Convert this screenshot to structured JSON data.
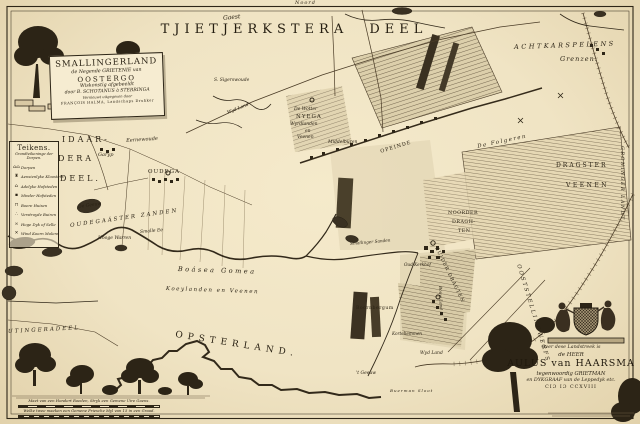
{
  "map": {
    "title": "TJIETJERKSTERA DEEL",
    "title_script": "Gaest",
    "north": "Noord"
  },
  "cartouche": {
    "l1": "SMALLINGERLAND",
    "l2": "de Negende GRIETENIE van",
    "l3": "OOSTERGO",
    "l4": "Wiskonstig afgebeeldt",
    "l5": "door B. SCHOTANUS à STERRINGA",
    "l6": "Vernieuwt uitgegeven door",
    "l7": "FRANÇOIS HALMA, Landschaps Drukker"
  },
  "legend": {
    "title": "Teikens.",
    "sub1": "Grondteikeninge der",
    "sub2": "Dorpen.",
    "items": [
      {
        "g": "⌂⌂",
        "t": "Dorpen"
      },
      {
        "g": "♜",
        "t": "Aensienlyke Kloosters"
      },
      {
        "g": "⌂",
        "t": "Adelyke Hofsteden"
      },
      {
        "g": "▪",
        "t": "Minder Hofsteden"
      },
      {
        "g": "⊓",
        "t": "Boere Huisen"
      },
      {
        "g": "∴",
        "t": "Verstroyde Buiren"
      },
      {
        "g": "≍",
        "t": "Hoge Dyk of Selle"
      },
      {
        "g": "✕",
        "t": "Wind Koorn Molens"
      }
    ]
  },
  "places": [
    {
      "id": "eernewoude",
      "text": "Eernewoude",
      "x": 126,
      "y": 139,
      "fs": 5,
      "it": true,
      "rot": -4
    },
    {
      "id": "garyp",
      "text": "Garyp",
      "x": 98,
      "y": 153,
      "fs": 5,
      "it": true
    },
    {
      "id": "sigerswoude",
      "text": "S. Sigerswoude",
      "x": 214,
      "y": 79,
      "fs": 4.5,
      "it": true
    },
    {
      "id": "wyd-land-noord",
      "text": "Wyd Land",
      "x": 227,
      "y": 112,
      "fs": 4.5,
      "it": true,
      "rot": -22
    },
    {
      "id": "de-wotter",
      "text": "De Wotter",
      "x": 294,
      "y": 108,
      "fs": 4.5,
      "it": true
    },
    {
      "id": "nyega",
      "text": "NYEGA",
      "x": 296,
      "y": 115,
      "fs": 5.5,
      "ls": 1
    },
    {
      "id": "wyrdlanden",
      "text": "Wyrdlanden",
      "x": 290,
      "y": 123,
      "fs": 4.5,
      "it": true
    },
    {
      "id": "en",
      "text": "en",
      "x": 305,
      "y": 130,
      "fs": 4.5,
      "it": true
    },
    {
      "id": "veenen-noord",
      "text": "Veenen",
      "x": 297,
      "y": 136,
      "fs": 4.5,
      "it": true
    },
    {
      "id": "middelburen",
      "text": "Middelburen",
      "x": 328,
      "y": 141,
      "fs": 4.5,
      "it": true
    },
    {
      "id": "opeinde",
      "text": "OPEINDE",
      "x": 380,
      "y": 150,
      "fs": 5,
      "ls": 1,
      "rot": -17
    },
    {
      "id": "de-folgeren",
      "text": "De Folgeren",
      "x": 477,
      "y": 145,
      "fs": 5.5,
      "it": true,
      "ls": 1.5,
      "rot": -12
    },
    {
      "id": "dragster",
      "text": "DRAGSTER",
      "x": 556,
      "y": 163,
      "fs": 6,
      "ls": 2
    },
    {
      "id": "veenen-oost",
      "text": "VEENEN",
      "x": 566,
      "y": 183,
      "fs": 6,
      "ls": 2.5
    },
    {
      "id": "noorder",
      "text": "NOORDER",
      "x": 448,
      "y": 212,
      "fs": 4.8,
      "ls": 0.5
    },
    {
      "id": "dragh",
      "text": "DRAGH-",
      "x": 452,
      "y": 221,
      "fs": 4.8,
      "ls": 0.5
    },
    {
      "id": "ten",
      "text": "TEN",
      "x": 458,
      "y": 230,
      "fs": 4.8,
      "ls": 0.5
    },
    {
      "id": "zuider-dragten",
      "text": "ZUIDER DRAGTEN",
      "x": 437,
      "y": 247,
      "fs": 4.8,
      "ls": 1,
      "rot": 64
    },
    {
      "id": "oud-kerkhof",
      "text": "Oud Kerkhof",
      "x": 404,
      "y": 263,
      "fs": 4.2,
      "it": true
    },
    {
      "id": "smallinger-sanden",
      "text": "Smallinger Sanden",
      "x": 350,
      "y": 242,
      "fs": 4.2,
      "it": true,
      "rot": -5
    },
    {
      "id": "oudega",
      "text": "OUDEGA",
      "x": 148,
      "y": 170,
      "fs": 5.5,
      "ls": 1
    },
    {
      "id": "de-geeuw",
      "text": "De Geeuw",
      "x": 78,
      "y": 206,
      "fs": 4.5,
      "it": true,
      "rot": -8
    },
    {
      "id": "smalle-ee",
      "text": "Smalle Ee",
      "x": 140,
      "y": 231,
      "fs": 4.5,
      "it": true,
      "rot": -5
    },
    {
      "id": "oudegaaster-zanden",
      "text": "OUDEGAÁSTER ZANDEN",
      "x": 70,
      "y": 224,
      "fs": 5.5,
      "it": true,
      "ls": 2,
      "rot": -8
    },
    {
      "id": "hooge-warren",
      "text": "Hooge Warren",
      "x": 98,
      "y": 237,
      "fs": 4.5,
      "it": true
    },
    {
      "id": "boasea-gomea",
      "text": "Boásea Gomea",
      "x": 178,
      "y": 266,
      "fs": 6.5,
      "it": true,
      "ls": 2.5,
      "rot": 2
    },
    {
      "id": "koeylanden-en-veenen",
      "text": "Koeylanden en Veenen",
      "x": 166,
      "y": 287,
      "fs": 5.5,
      "it": true,
      "ls": 1.5,
      "rot": 2
    },
    {
      "id": "boornbergum",
      "text": "Boornbergum",
      "x": 356,
      "y": 307,
      "fs": 4.6,
      "ls": 0.5
    },
    {
      "id": "kortehemmen",
      "text": "Kortehemmen",
      "x": 392,
      "y": 332,
      "fs": 4.2,
      "it": true
    },
    {
      "id": "bouw-land",
      "text": "Bouw Land",
      "x": 442,
      "y": 286,
      "fs": 4.2,
      "it": true,
      "rot": 88
    },
    {
      "id": "wyd-land-zuid",
      "text": "Wyd Land",
      "x": 420,
      "y": 352,
      "fs": 4.5,
      "it": true
    },
    {
      "id": "t-geeuw",
      "text": "'t Geeuw",
      "x": 356,
      "y": 372,
      "fs": 4.5,
      "it": true
    },
    {
      "id": "buerman-sloot",
      "text": "Buerman Sloot",
      "x": 390,
      "y": 389,
      "fs": 4,
      "it": true,
      "ls": 1
    },
    {
      "id": "groninger-landt",
      "text": "GRONINGER LANDT",
      "x": 623,
      "y": 146,
      "fs": 4.8,
      "it": true,
      "ls": 1.5,
      "rot": 90
    },
    {
      "id": "idaar",
      "text": "IDAAR-",
      "x": 62,
      "y": 136,
      "fs": 8,
      "ls": 3
    },
    {
      "id": "dera",
      "text": "DERA",
      "x": 58,
      "y": 155,
      "fs": 8,
      "ls": 3
    },
    {
      "id": "deel",
      "text": "DEEL.",
      "x": 60,
      "y": 175,
      "fs": 8,
      "ls": 3
    },
    {
      "id": "achtkarspelens",
      "text": "ACHTKARSPELENS",
      "x": 514,
      "y": 44,
      "fs": 6.5,
      "it": true,
      "ls": 2.5,
      "rot": -2
    },
    {
      "id": "grenzen",
      "text": "Grenzen.",
      "x": 560,
      "y": 56,
      "fs": 6.5,
      "it": true,
      "ls": 1
    },
    {
      "id": "utingeradeel",
      "text": "UTINGERADEEL",
      "x": 8,
      "y": 330,
      "fs": 5.5,
      "it": true,
      "ls": 2,
      "rot": -3
    },
    {
      "id": "opsterland",
      "text": "OPSTERLAND.",
      "x": 176,
      "y": 331,
      "fs": 9,
      "ls": 5,
      "rot": 9
    },
    {
      "id": "ooststellingwerfs",
      "text": "OOSTSTELLINGWERFS",
      "x": 520,
      "y": 264,
      "fs": 5.5,
      "it": true,
      "ls": 2,
      "rot": 73
    }
  ],
  "dedication": {
    "l1": "Over dese Landstreek is",
    "l2": "de HEER",
    "l3": "AULUS van HAARSMA",
    "l4": "tegenwoordig GRIETMAN",
    "l5": "en DYKGRAAF van de Leppedyk etc.",
    "l6": "CIƆ IƆ CCXVIII"
  },
  "scale": {
    "l1": "Maet van een Hondert Roeden, Stryk een Gemene Uire Gaens.",
    "l2": "Welke twee maeken een Gemene Friesche Myl van 15 in een Graad."
  },
  "colors": {
    "paper": "#f0e4c4",
    "ink": "#2b2315",
    "water": "#3a3122"
  }
}
